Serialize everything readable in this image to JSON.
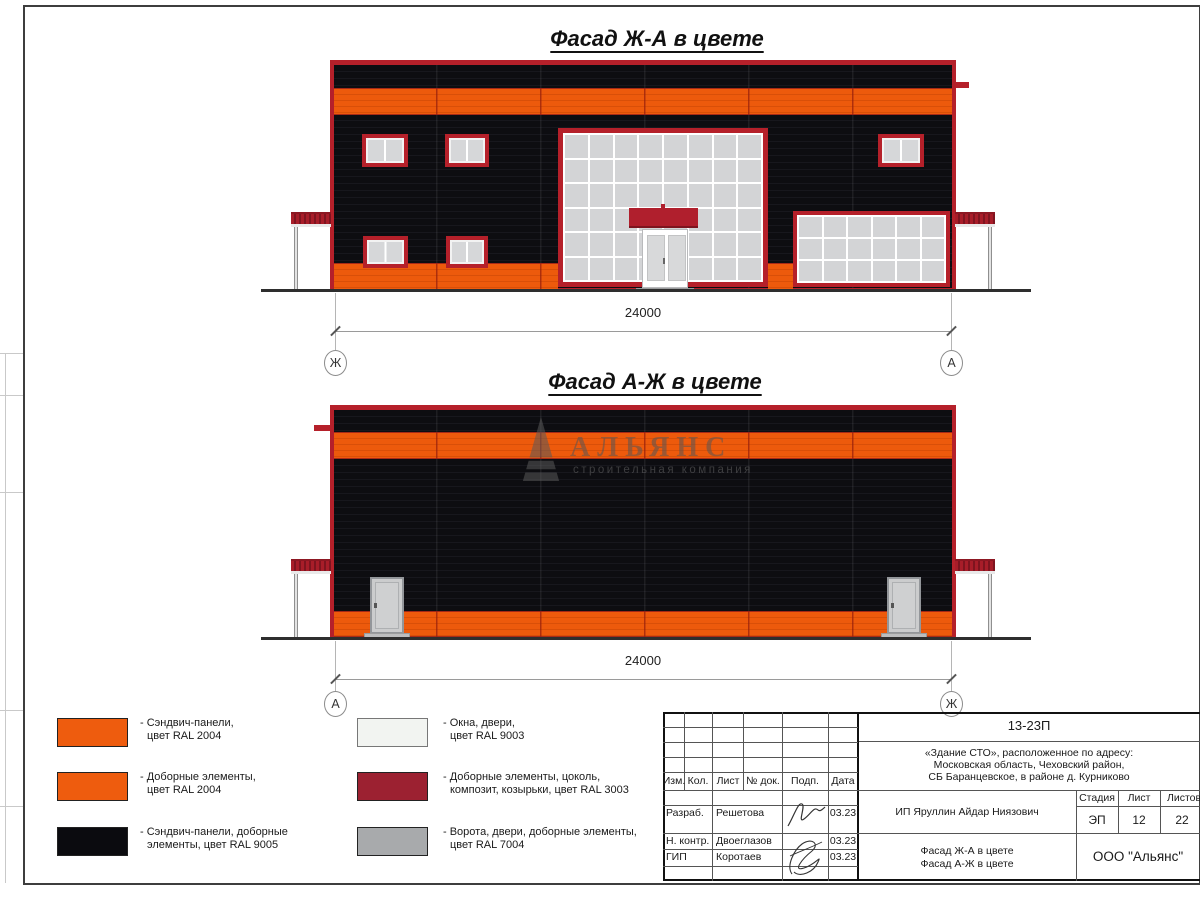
{
  "sheet": {
    "facade1_title": "Фасад Ж-А в цвете",
    "facade2_title": "Фасад А-Ж в цвете",
    "dim1": "24000",
    "dim2": "24000",
    "axis": {
      "f1_left": "Ж",
      "f1_right": "А",
      "f2_left": "А",
      "f2_right": "Ж"
    },
    "watermark": {
      "name": "АЛЬЯНС",
      "subtitle": "строительная компания"
    },
    "colors": {
      "orange_ral2004": "#ED5A0C",
      "black_ral9005": "#0D0D11",
      "red_frame_ral3003": "#B5202A",
      "white_ral9003": "#F2F4F1",
      "gray_ral7004": "#A8AAAC"
    }
  },
  "legend": {
    "items": [
      {
        "color": "#EE5C0E",
        "line1": "- Сэндвич-панели,",
        "line2": "цвет RAL 2004"
      },
      {
        "color": "#EE5C0E",
        "line1": "- Доборные элементы,",
        "line2": "цвет RAL 2004"
      },
      {
        "color": "#0B0B0F",
        "line1": "- Сэндвич-панели, доборные",
        "line2": "элементы, цвет RAL 9005"
      },
      {
        "color": "#F2F4F1",
        "line1": "- Окна, двери,",
        "line2": "цвет RAL 9003"
      },
      {
        "color": "#9C2131",
        "line1": "- Доборные элементы, цоколь,",
        "line2": "композит, козырьки, цвет RAL 3003"
      },
      {
        "color": "#A8AAAC",
        "line1": "- Ворота, двери, доборные элементы,",
        "line2": "цвет RAL 7004"
      }
    ]
  },
  "titleblock": {
    "doc_number": "13-23П",
    "project_line1": "«Здание СТО», расположенное по адресу:",
    "project_line2": "Московская область, Чеховский район,",
    "project_line3": "СБ Баранцевское, в районе д. Курниково",
    "client": "ИП Яруллин Айдар Ниязович",
    "col_izm": "Изм.",
    "col_kol": "Кол.",
    "col_list": "Лист",
    "col_ndok": "№ док.",
    "col_podp": "Подп.",
    "col_data": "Дата",
    "stage_label": "Стадия",
    "sheet_label": "Лист",
    "sheets_label": "Листов",
    "stage_value": "ЭП",
    "sheet_value": "12",
    "sheets_value": "22",
    "rows": [
      {
        "role": "Разраб.",
        "name": "Решетова",
        "date": "03.23"
      },
      {
        "role": "Н. контр.",
        "name": "Двоеглазов",
        "date": "03.23"
      },
      {
        "role": "ГИП",
        "name": "Коротаев",
        "date": "03.23"
      }
    ],
    "drawing_line1": "Фасад Ж-А в цвете",
    "drawing_line2": "Фасад А-Ж в цвете",
    "company": "ООО \"Альянс\""
  }
}
